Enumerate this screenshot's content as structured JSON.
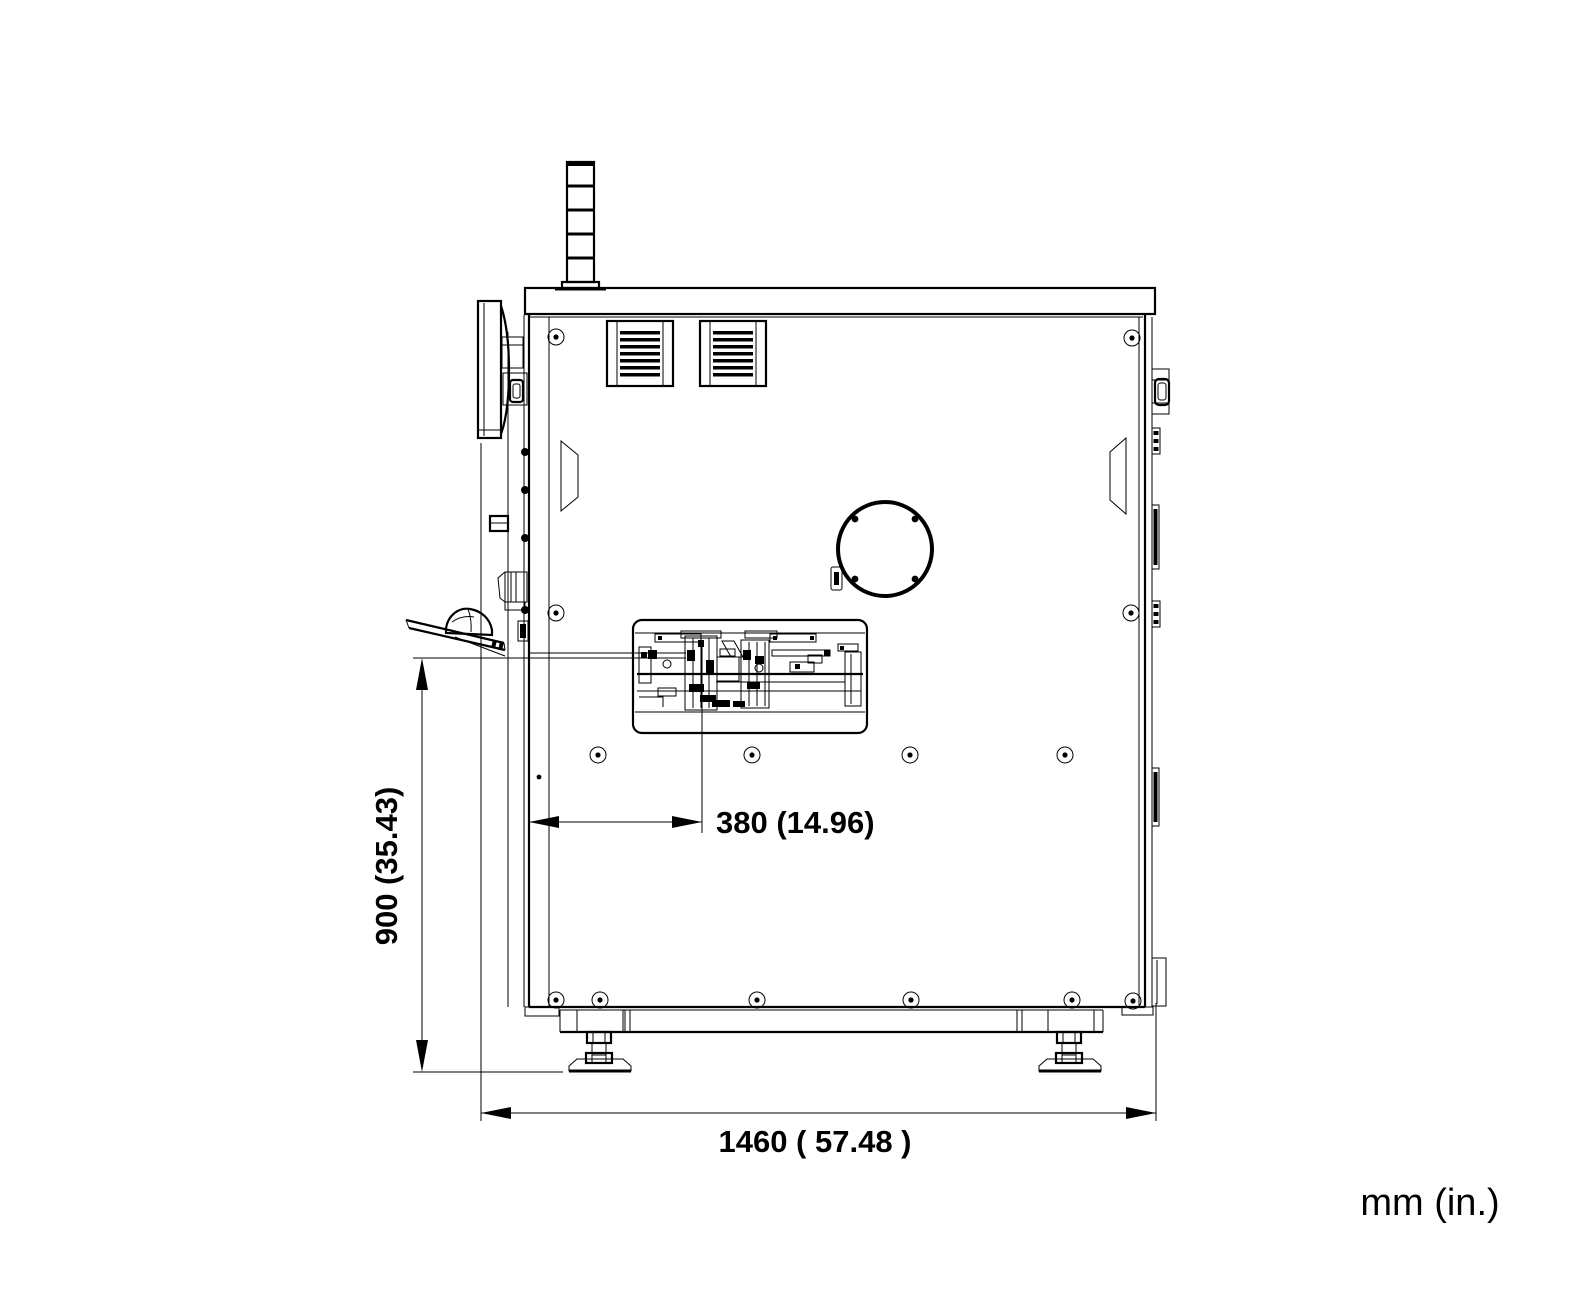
{
  "diagram": {
    "type": "technical-dimension-drawing",
    "view": "machine side elevation",
    "units_label": "mm (in.)",
    "dimensions": {
      "height": {
        "label": "900 (35.43)",
        "mm": 900,
        "inches": 35.43,
        "orientation": "vertical"
      },
      "mechanism_offset": {
        "label": "380 (14.96)",
        "mm": 380,
        "inches": 14.96,
        "orientation": "horizontal"
      },
      "width": {
        "label": "1460 ( 57.48 )",
        "mm": 1460,
        "inches": 57.48,
        "orientation": "horizontal"
      }
    },
    "colors": {
      "line": "#000000",
      "background": "#ffffff"
    }
  }
}
